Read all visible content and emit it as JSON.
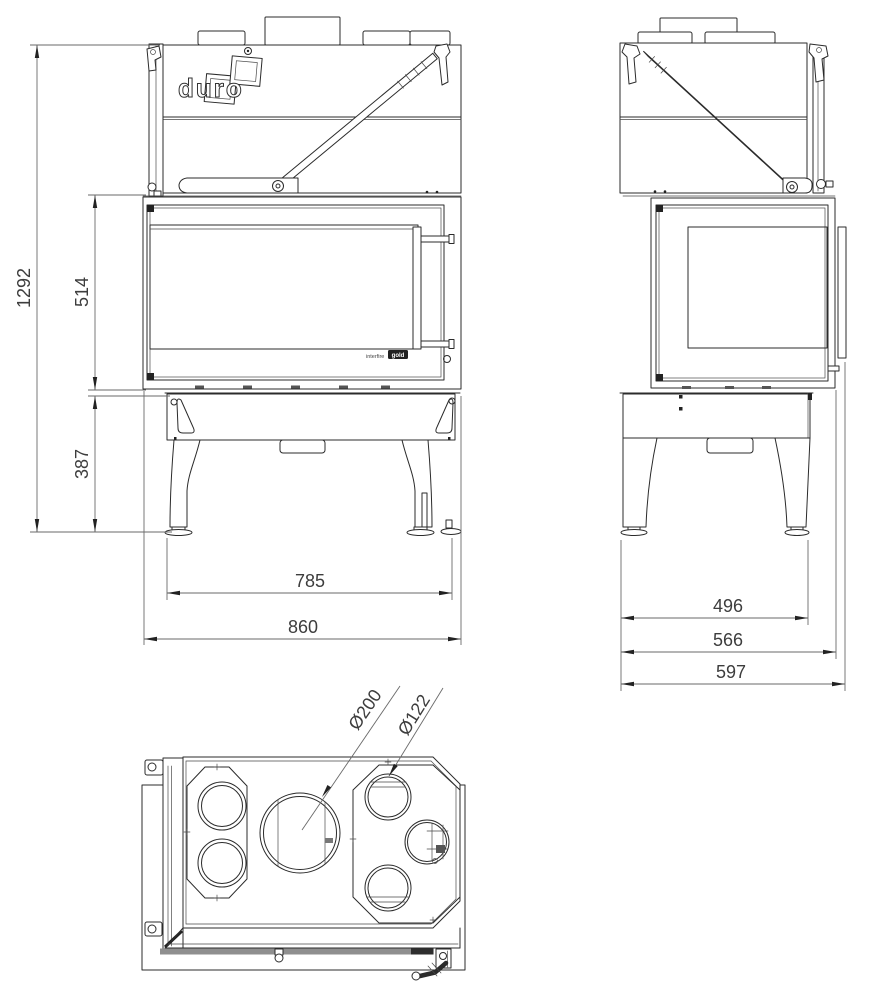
{
  "drawing": {
    "brand_logo": "duro",
    "glass_badge": {
      "prefix": "interfire",
      "boxed": "gold"
    },
    "dimensions": {
      "front": {
        "total_height_mm": "1292",
        "door_height_mm": "514",
        "base_height_mm": "387",
        "feet_span_mm": "785",
        "total_width_mm": "860"
      },
      "side": {
        "feet_depth_mm": "496",
        "body_depth_mm": "566",
        "total_depth_mm": "597"
      },
      "top": {
        "flue_diameter": "Ø200",
        "duct_diameter": "Ø122"
      }
    }
  }
}
